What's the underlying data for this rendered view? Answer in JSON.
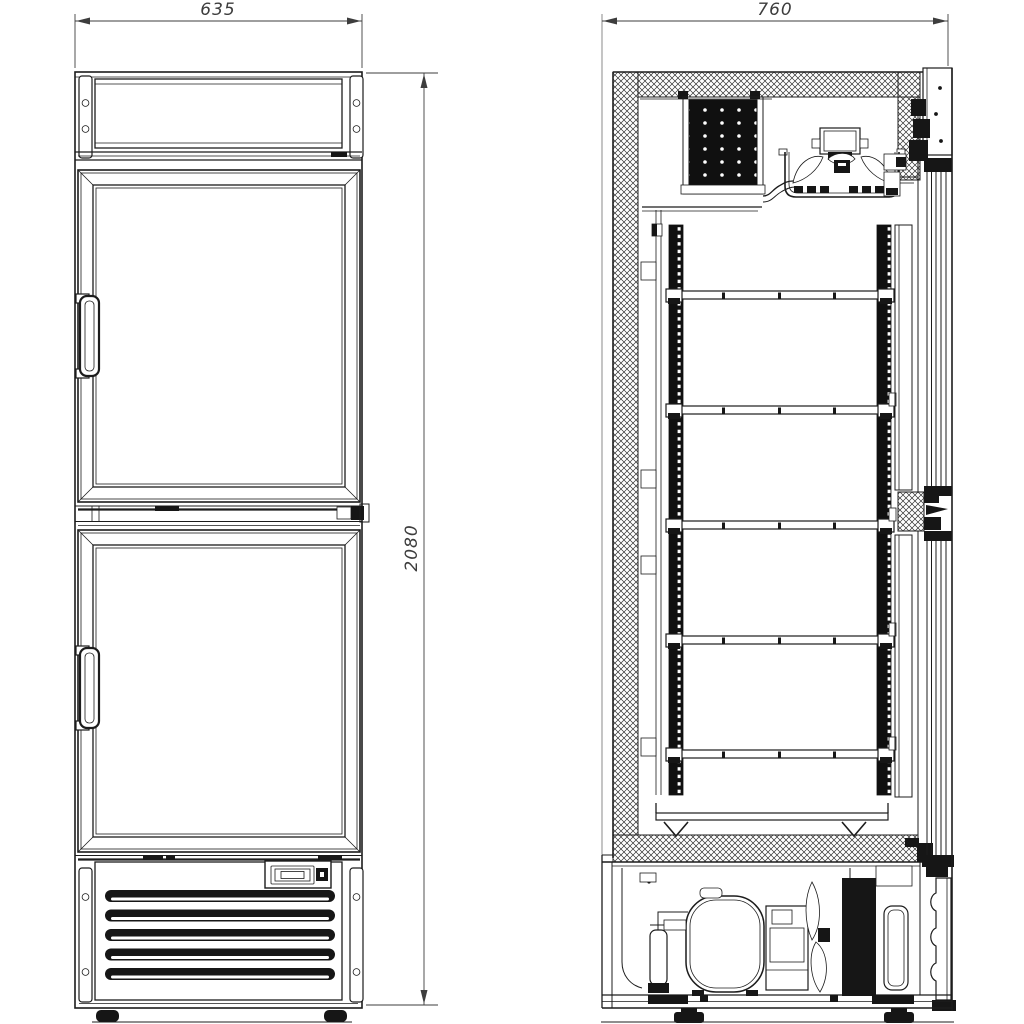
{
  "drawing": {
    "background_color": "#ffffff",
    "line_color": "#1c1c1c",
    "dimension_color": "#3d3d3d",
    "dimensions": {
      "front_width_mm": "635",
      "depth_mm": "760",
      "overall_height_mm": "2080"
    }
  }
}
